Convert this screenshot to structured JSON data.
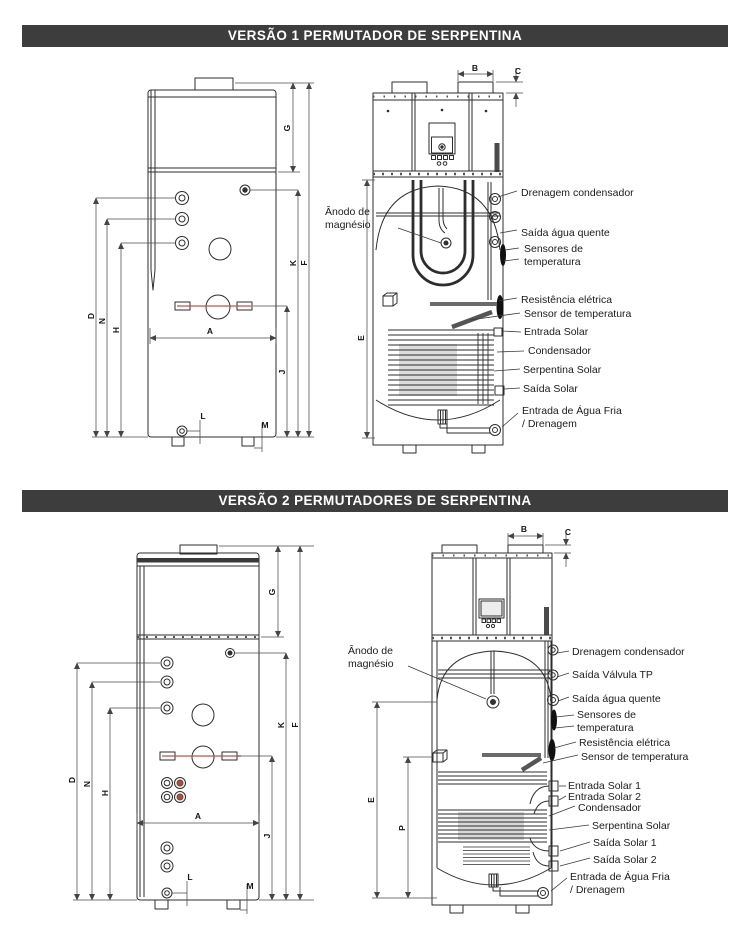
{
  "page": {
    "header_bg": "#3d3d3d",
    "header_text_color": "#ffffff",
    "line_color": "#2d2d2d",
    "accent_red": "#c0504d"
  },
  "sections": [
    {
      "title": "VERSÃO 1 PERMUTADOR DE SERPENTINA",
      "anode_label": "Ânodo de\nmagnésio",
      "labels": {
        "drenagem": "Drenagem condensador",
        "saida_agua_quente": "Saída água quente",
        "sensores": "Sensores de\ntemperatura",
        "resistencia": "Resistência elétrica",
        "sensor_temp": "Sensor de temperatura",
        "entrada_solar": "Entrada Solar",
        "condensador": "Condensador",
        "serpentina": "Serpentina Solar",
        "saida_solar": "Saída Solar",
        "entrada_agua_fria": "Entrada de Água Fria\n/ Drenagem"
      },
      "dims": {
        "A": "A",
        "B": "B",
        "C": "C",
        "D": "D",
        "E": "E",
        "F": "F",
        "G": "G",
        "H": "H",
        "J": "J",
        "K": "K",
        "L": "L",
        "M": "M",
        "N": "N"
      }
    },
    {
      "title": "VERSÃO 2 PERMUTADORES DE SERPENTINA",
      "anode_label": "Ânodo de\nmagnésio",
      "labels": {
        "drenagem": "Drenagem condensador",
        "saida_valvula_tp": "Saída Válvula TP",
        "saida_agua_quente": "Saída água quente",
        "sensores": "Sensores de\ntemperatura",
        "resistencia": "Resistência elétrica",
        "sensor_temp": "Sensor de temperatura",
        "entrada_solar_1": "Entrada Solar 1",
        "entrada_solar_2": "Entrada Solar 2",
        "condensador": "Condensador",
        "serpentina": "Serpentina Solar",
        "saida_solar_1": "Saída Solar 1",
        "saida_solar_2": "Saída Solar 2",
        "entrada_agua_fria": "Entrada de Água Fria\n/ Drenagem"
      },
      "dims": {
        "A": "A",
        "B": "B",
        "C": "C",
        "D": "D",
        "E": "E",
        "F": "F",
        "G": "G",
        "H": "H",
        "J": "J",
        "K": "K",
        "L": "L",
        "M": "M",
        "N": "N",
        "P": "P"
      }
    }
  ]
}
